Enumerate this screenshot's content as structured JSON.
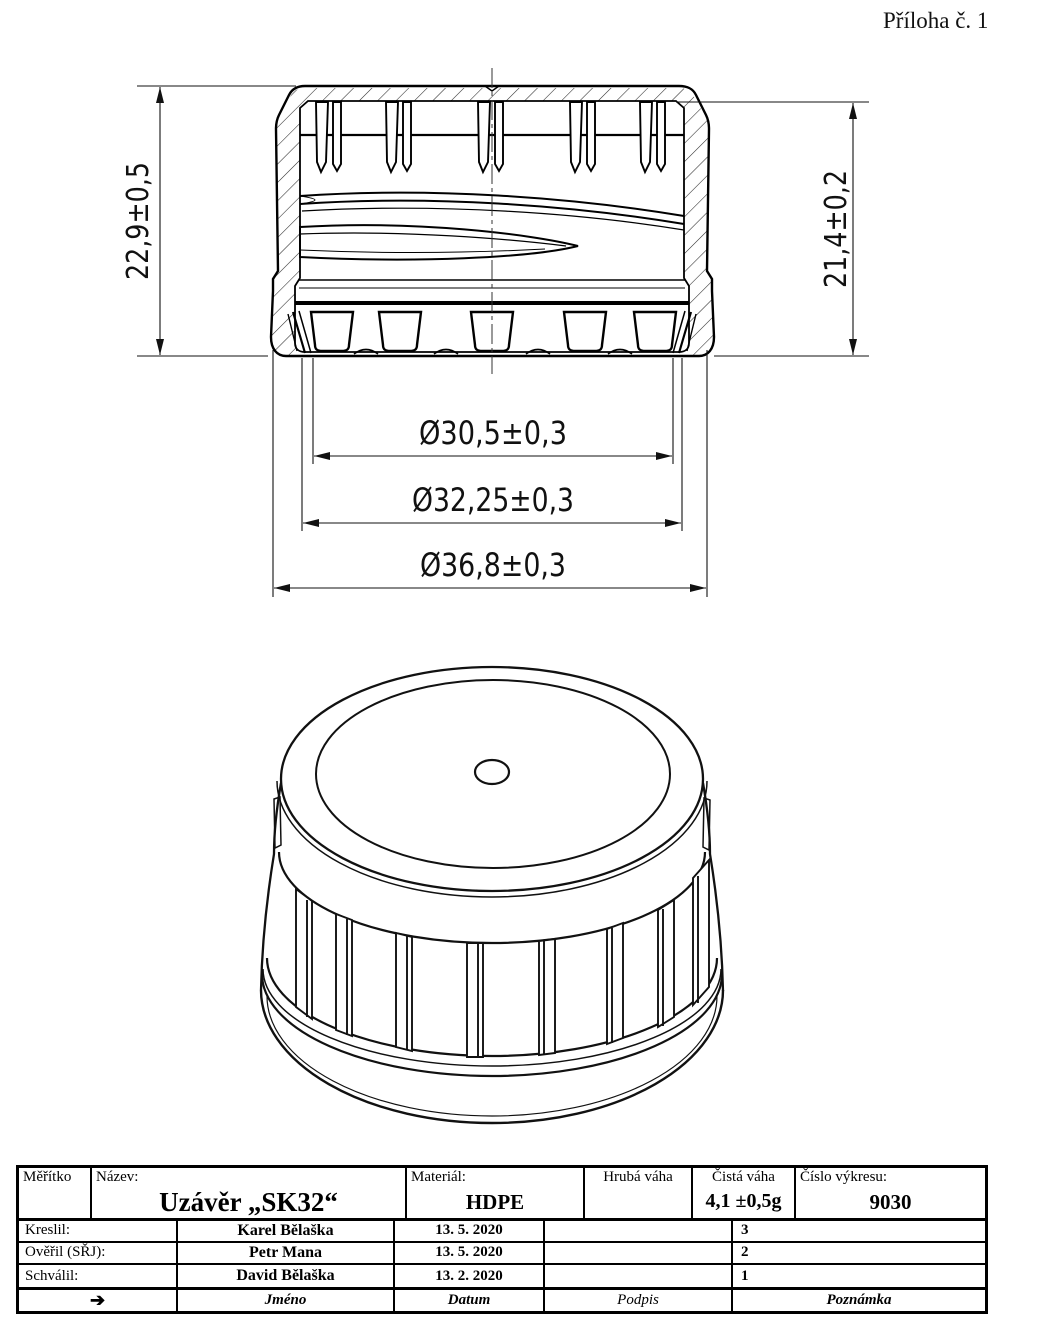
{
  "page": {
    "annotation": "Příloha č. 1"
  },
  "drawing": {
    "part": "plastic screw cap, section view and isometric view",
    "front_view": {
      "dim_height_outer": "22,9±0,5",
      "dim_height_inner": "21,4±0,2",
      "dim_dia_inner": "Ø30,5±0,3",
      "dim_dia_thread": "Ø32,25±0,3",
      "dim_dia_outer": "Ø36,8±0,3"
    }
  },
  "title_block": {
    "scale_label": "Měřítko",
    "name_label": "Název:",
    "name_value": "Uzávěr „SK32“",
    "material_label": "Materiál:",
    "material_value": "HDPE",
    "gross_weight_label": "Hrubá váha",
    "gross_weight_value": "",
    "net_weight_label": "Čistá váha",
    "net_weight_value": "4,1 ±0,5g",
    "drawing_number_label": "Číslo výkresu:",
    "drawing_number_value": "9030",
    "rows": [
      {
        "role": "Kreslil:",
        "name": "Karel Bělaška",
        "date": "13. 5. 2020",
        "signature": "",
        "note": "3"
      },
      {
        "role": "Ověřil (SŘJ):",
        "name": "Petr Mana",
        "date": "13. 5. 2020",
        "signature": "",
        "note": "2"
      },
      {
        "role": "Schválil:",
        "name": "David Bělaška",
        "date": "13. 2. 2020",
        "signature": "",
        "note": "1"
      }
    ],
    "footer": {
      "arrow": "➔",
      "name": "Jméno",
      "date": "Datum",
      "signature": "Podpis",
      "note": "Poznámka"
    }
  }
}
